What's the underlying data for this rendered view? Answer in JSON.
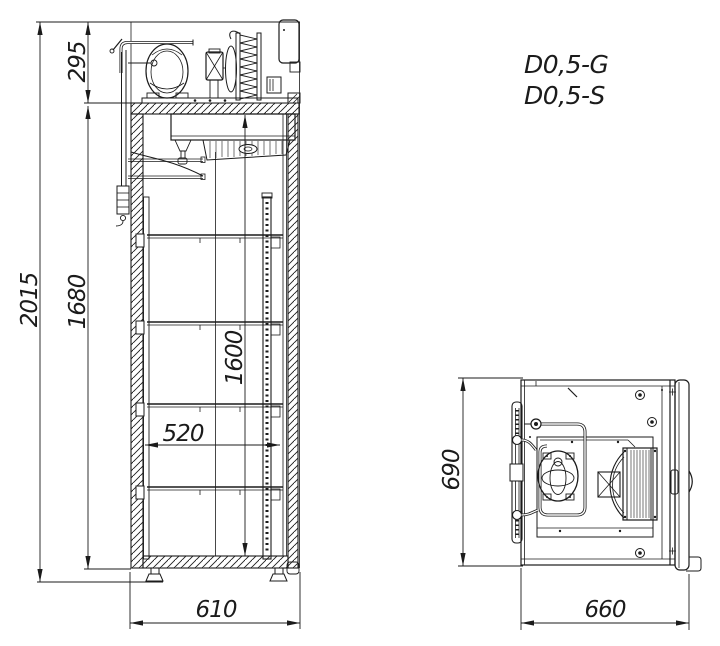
{
  "drawing": {
    "background": "#ffffff",
    "line_color": "#1b1b1b"
  },
  "models": {
    "line1": "D0,5-G",
    "line2": "D0,5-S"
  },
  "side_view": {
    "dims": {
      "overall_height": "2015",
      "machinery_height": "295",
      "body_height": "1680",
      "interior_height": "1600",
      "interior_depth": "520",
      "overall_depth": "610"
    }
  },
  "top_view": {
    "dims": {
      "depth": "690",
      "width": "660"
    }
  }
}
